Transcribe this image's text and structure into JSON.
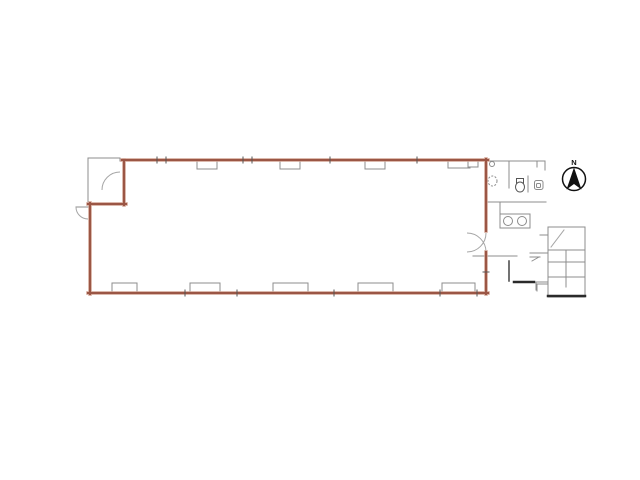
{
  "meta": {
    "width": 640,
    "height": 480,
    "type": "architectural-floor-plan"
  },
  "colors": {
    "background": "#ffffff",
    "wall_core": "#9b5645",
    "wall_halo": "#d1a292",
    "thin_line": "#8c8c8c",
    "light_line": "#a5a5a5",
    "dark_line": "#2a2a2a",
    "tick": "#555555"
  },
  "plan": {
    "main_room": {
      "red_walls": [
        [
          122,
          160,
          488,
          160
        ],
        [
          486,
          159,
          486,
          231
        ],
        [
          486,
          252,
          486,
          294
        ],
        [
          88,
          293,
          488,
          293
        ],
        [
          90,
          203,
          90,
          294
        ],
        [
          88,
          204,
          126,
          204
        ],
        [
          124,
          160,
          124,
          205
        ]
      ]
    },
    "windows": {
      "top": [
        [
          197,
          160,
          20,
          9
        ],
        [
          280,
          160,
          20,
          9
        ],
        [
          365,
          160,
          20,
          9
        ],
        [
          448,
          159,
          22,
          9
        ]
      ],
      "top_small_square": [
        468,
        159,
        10,
        8
      ],
      "bottom": [
        [
          112,
          283,
          25,
          10
        ],
        [
          190,
          283,
          30,
          10
        ],
        [
          273,
          283,
          35,
          10
        ],
        [
          358,
          283,
          35,
          10
        ],
        [
          442,
          283,
          33,
          10
        ]
      ]
    },
    "vestibule": {
      "lines": [
        [
          88,
          158,
          88,
          204
        ],
        [
          88,
          158,
          120,
          158
        ],
        [
          120,
          158,
          120,
          161
        ]
      ],
      "door_arc": "M 120 172 A 18 18 0 0 0 102 190"
    },
    "left_door": {
      "leaf": [
        76,
        207,
        88,
        207
      ],
      "arc": "M 76 207 A 12 12 0 0 0 88 219"
    },
    "entry_door": {
      "arcs": [
        "M 467 233 A 19 19 0 0 1 486 252",
        "M 467 252 A 19 19 0 0 0 486 233"
      ]
    },
    "restroom": {
      "lines": [
        [
          488,
          161,
          545,
          161
        ],
        [
          545,
          161,
          545,
          170
        ],
        [
          509,
          161,
          509,
          188
        ],
        [
          528,
          176,
          528,
          192
        ],
        [
          537,
          161,
          537,
          167
        ],
        [
          488,
          202,
          546,
          202
        ],
        [
          500,
          202,
          500,
          214
        ]
      ],
      "counter_rect": [
        500,
        214,
        30,
        14
      ],
      "sink_circles": [
        [
          508,
          221,
          4.5
        ],
        [
          522,
          221,
          4.5
        ]
      ],
      "small_circle": [
        492,
        164,
        2.5
      ],
      "dashed_basin": [
        492.5,
        181,
        4.5,
        5
      ],
      "toilet_tank": [
        516.5,
        178.5,
        7,
        4.5
      ],
      "toilet_bowl": [
        520,
        187,
        4.5,
        5
      ],
      "sink_square": [
        534.5,
        180.5,
        8.5,
        9
      ],
      "sink_square_inner": [
        536.5,
        183.5,
        4,
        4
      ]
    },
    "corridor": {
      "lines": [
        [
          473,
          256,
          517,
          256
        ],
        [
          530,
          257,
          540,
          257
        ],
        [
          532,
          261,
          539,
          257
        ],
        [
          537,
          284,
          537,
          291
        ],
        [
          537,
          284,
          548,
          284
        ]
      ],
      "door_leaf": [
        509,
        261,
        509,
        281
      ],
      "thick_line": [
        514,
        282,
        534,
        282
      ]
    },
    "stairs": {
      "outline": [
        548,
        227,
        37,
        70
      ],
      "treads": [
        [
          548,
          250,
          585,
          250
        ],
        [
          548,
          262,
          585,
          262
        ],
        [
          548,
          277,
          585,
          277
        ]
      ],
      "mid_rail": [
        566,
        250,
        566,
        287
      ],
      "diagonal": [
        551,
        247,
        564,
        230
      ],
      "stubs": [
        [
          540,
          235,
          548,
          235
        ],
        [
          530,
          253,
          548,
          253
        ],
        [
          536,
          282,
          548,
          282
        ],
        [
          536,
          282,
          536,
          290
        ]
      ],
      "thick_bottom": [
        548,
        296,
        585,
        296
      ]
    },
    "ticks": [
      [
        157,
        157,
        157,
        163
      ],
      [
        166,
        157,
        166,
        163
      ],
      [
        243,
        157,
        243,
        163
      ],
      [
        252,
        157,
        252,
        163
      ],
      [
        330,
        157,
        330,
        163
      ],
      [
        417,
        157,
        417,
        163
      ],
      [
        185,
        290,
        185,
        296
      ],
      [
        237,
        290,
        237,
        296
      ],
      [
        334,
        290,
        334,
        296
      ],
      [
        440,
        290,
        440,
        296
      ],
      [
        477,
        290,
        477,
        296
      ],
      [
        483,
        272,
        489,
        272
      ]
    ],
    "compass": {
      "label": "N",
      "cx": 574,
      "cy": 179,
      "r": 11.5
    }
  }
}
